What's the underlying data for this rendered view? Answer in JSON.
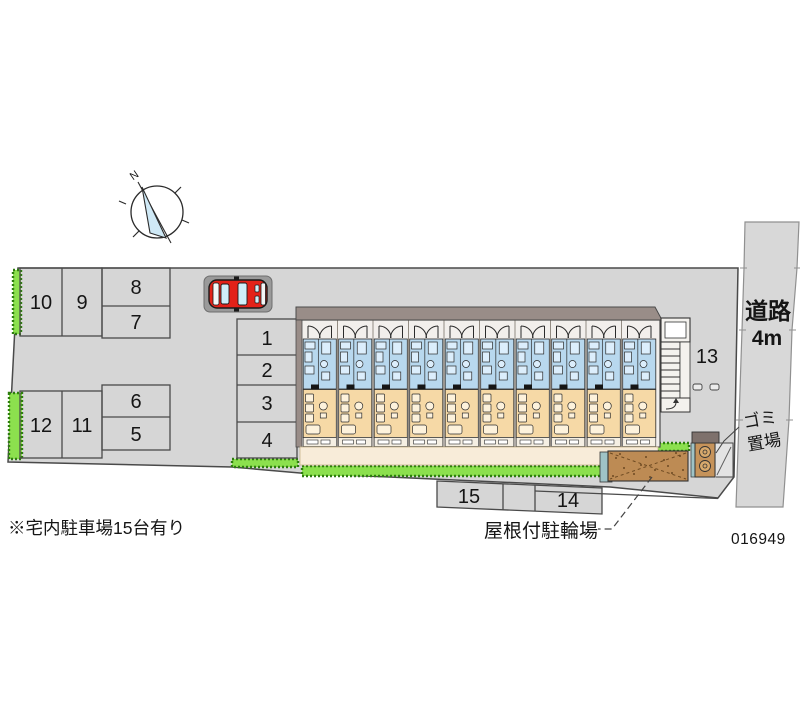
{
  "site_plan": {
    "note": "※宅内駐車場15台有り",
    "plan_number": "016949",
    "compass": {
      "north_label": "N"
    },
    "road": {
      "label": "道路",
      "width_label": "4m"
    },
    "garbage": {
      "label_line1": "ゴミ",
      "label_line2": "置場"
    },
    "bicycle_shed": {
      "label": "屋根付駐輪場"
    },
    "building": {
      "unit_count": 10
    },
    "parking": {
      "stall_count": 15,
      "stalls": [
        {
          "label": "1"
        },
        {
          "label": "2"
        },
        {
          "label": "3"
        },
        {
          "label": "4"
        },
        {
          "label": "5"
        },
        {
          "label": "6"
        },
        {
          "label": "7"
        },
        {
          "label": "8"
        },
        {
          "label": "9"
        },
        {
          "label": "10"
        },
        {
          "label": "11"
        },
        {
          "label": "12"
        },
        {
          "label": "13"
        },
        {
          "label": "14"
        },
        {
          "label": "15"
        }
      ]
    }
  },
  "colors": {
    "site_gray": "#d6d6d6",
    "road_gray": "#d8d8d8",
    "outline": "#4a4a4a",
    "hedge_green": "#8ce04e",
    "hedge_edge": "#2e7d0f",
    "roof_gray": "#998d88",
    "unit_blue": "#b8d8ee",
    "unit_tan": "#f6d9a6",
    "walkway_cream": "#f8ecd9",
    "car_red": "#e32219",
    "window_blue": "#cfeef8",
    "shed_brown": "#bd8b54",
    "teal": "#9fc3c6"
  }
}
